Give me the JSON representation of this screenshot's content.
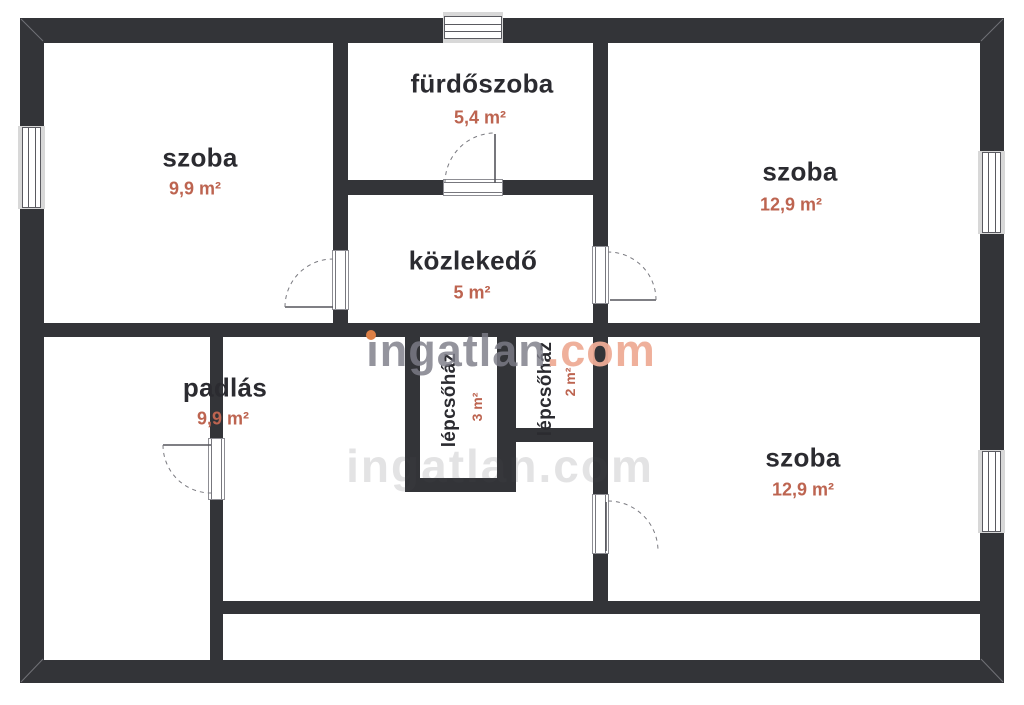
{
  "plan": {
    "watermark": {
      "name": "ingatlan",
      "tld": ".com"
    },
    "watermark_ghost": "ingatlan.com",
    "rooms": [
      {
        "id": "room-top-left",
        "name": "szoba",
        "area": "9,9 m²"
      },
      {
        "id": "bathroom",
        "name": "fürdőszoba",
        "area": "5,4 m²"
      },
      {
        "id": "room-top-right",
        "name": "szoba",
        "area": "12,9 m²"
      },
      {
        "id": "hallway",
        "name": "közlekedő",
        "area": "5 m²"
      },
      {
        "id": "attic",
        "name": "padlás",
        "area": "9,9 m²"
      },
      {
        "id": "staircase-left",
        "name": "lépcsőház",
        "area": "3 m²"
      },
      {
        "id": "staircase-right",
        "name": "lépcsőház",
        "area": "2 m²"
      },
      {
        "id": "room-bottom-right",
        "name": "szoba",
        "area": "12,9 m²"
      }
    ],
    "colors": {
      "wall": "#333438",
      "room_text": "#2b2b30",
      "area_text": "#bd6450",
      "watermark_gray": "#7d7d88",
      "watermark_salmon": "#eeac96",
      "watermark_dot": "#dd7f45"
    }
  }
}
